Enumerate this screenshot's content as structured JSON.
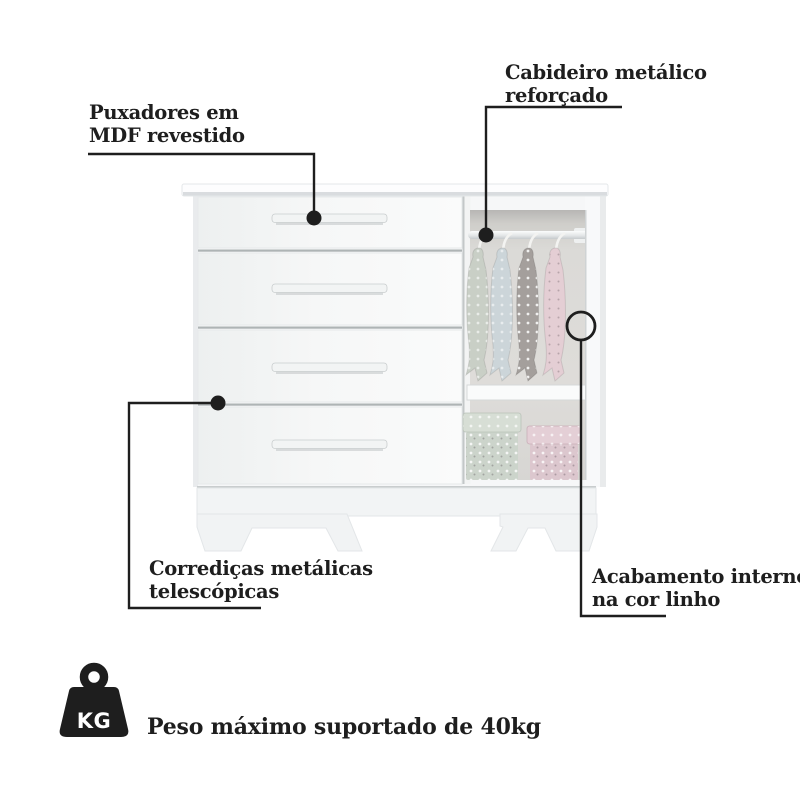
{
  "page": {
    "background": "#ffffff"
  },
  "colors": {
    "ink": "#1e1e1e",
    "furniture_white": "#f6f7f8",
    "interior_linen": "#dbdad7",
    "garment_sage": "#c9cfc6",
    "garment_blue": "#ccd5d9",
    "garment_grey": "#a49f9c",
    "garment_pink": "#e4ced4",
    "basket_mint": "#ccd4cb",
    "basket_mint_lid": "#d7ded5",
    "basket_pink": "#dcc7ce",
    "basket_pink_lid": "#e4cfd6"
  },
  "furniture": {
    "drawer_count": 4,
    "hanging_garment_count": 4,
    "basket_count": 2
  },
  "callouts": {
    "handles": {
      "lines": [
        "Puxadores em",
        "MDF revestido"
      ]
    },
    "rod": {
      "lines": [
        "Cabideiro metálico",
        "reforçado"
      ]
    },
    "slides": {
      "lines": [
        "Corrediças metálicas",
        "telescópicas"
      ]
    },
    "interior": {
      "lines": [
        "Acabamento interno",
        "na cor linho"
      ]
    }
  },
  "footer": {
    "icon": "kg-weight-icon",
    "icon_label": "KG",
    "text": "Peso máximo suportado de 40kg"
  }
}
